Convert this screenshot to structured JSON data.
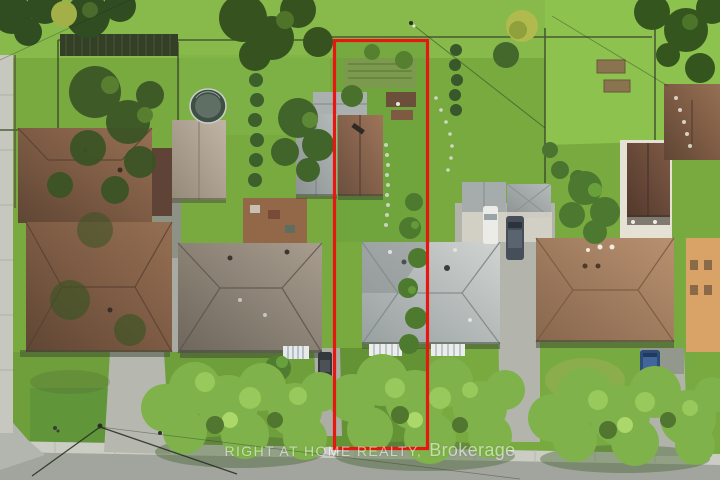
{
  "image": {
    "type": "aerial-drone-photograph",
    "description": "Top-down aerial view of a residential street block; a long narrow property lot is outlined in red from the rear fence to the street, passing over a rear house with a brown roof and half of a grey-roofed front house. Neighbouring houses, backyards, a round pool, driveways with parked cars, street trees and a road run along the bottom."
  },
  "watermark": {
    "line_main": "RIGHT AT HOME REALTY,",
    "line_suffix": "Brokerage",
    "color": "#ffffff"
  },
  "boundary": {
    "shape": "rectangle",
    "color": "#e81610"
  },
  "palette": {
    "lawn_green": "#79aa40",
    "backyard_green_light": "#8ec24f",
    "tree_green_dark": "#35551f",
    "street_tree_green": "#7fb24a",
    "asphalt_gray": "#a2a49e",
    "sidewalk_concrete": "#cbcdc5",
    "left_house_roof_brown": "#7d5b44",
    "front_house_roof_gray": "#b7bbba",
    "subject_house_roof_brown": "#8a674f",
    "right_house_roof_tan": "#a07a5e",
    "pool_cover_gray": "#4a5a50",
    "orange_building_wall": "#d9a266"
  }
}
